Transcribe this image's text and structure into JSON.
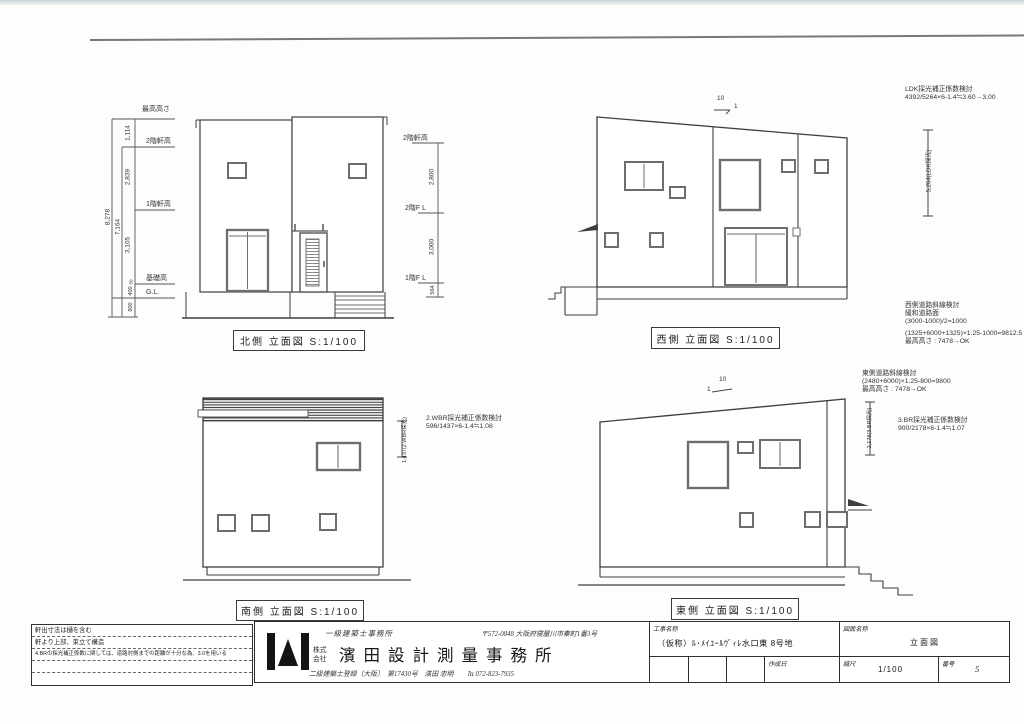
{
  "colors": {
    "ink": "#3a3a3a",
    "frame_line": "#787878",
    "window_gray": "#6e6e6e"
  },
  "views": {
    "north": {
      "label": "北側 立面図 S:1/100",
      "levels": {
        "max": "最高高さ",
        "eave2": "2階軒高",
        "eave1": "1階軒高",
        "foundation": "基礎高",
        "gl": "G.L."
      },
      "dims": {
        "d1114": "1,114",
        "d2839": "2,839",
        "d3105": "3,105",
        "d50": "50",
        "d400": "400",
        "d800": "800",
        "d7164": "7,164",
        "d8278": "8,278"
      }
    },
    "west": {
      "label": "西側 立面図 S:1/100",
      "slope_rise": "10",
      "slope_run": "1",
      "levels": {
        "eave2": "2階軒高",
        "fl2": "2階F L",
        "fl1": "1階F L"
      },
      "dims": {
        "d2800": "2,800",
        "d3000": "3,000",
        "d564": "564",
        "ldk": "5,264(LDK採光)"
      },
      "ldk_check": {
        "l1": "LDK採光補正係数検討",
        "l2": "4392/5264×6-1.4≒3.60→3.00"
      },
      "road_check": {
        "l1": "西側道路斜線検討",
        "l2": "緩和道路面",
        "l3": "(3000-1000)/2=1000",
        "l4": "(1325+6000+1325)×1.25-1000=9812.5",
        "l5": "最高高さ : 7478→OK"
      }
    },
    "south": {
      "label": "南側 立面図 S:1/100",
      "dims": {
        "wbr": "1,437(2.WBR採光)"
      },
      "wbr_check": {
        "l1": "2.WBR採光補正係数検討",
        "l2": "596/1437×6-1.4≒1.08"
      }
    },
    "east": {
      "label": "東側 立面図 S:1/100",
      "slope_rise": "10",
      "slope_run": "1",
      "road_check": {
        "l1": "東側道路斜線検討",
        "l2": "(2480+6000)×1.25-800=9800",
        "l3": "最高高さ : 7478→OK"
      },
      "dims": {
        "br": "2,178(3.BR採光)"
      },
      "br_check": {
        "l1": "3.BR採光補正係数検討",
        "l2": "900/2178×6-1.4≒1.07"
      }
    }
  },
  "titleblock": {
    "notes": {
      "n1": "軒出寸法は樋を含む",
      "n2": "軒より上部、束立て構造",
      "n3": "4.BRの採光補正係数に関しては、道路対側までの距離が十分な為、3.0を用いる"
    },
    "office_class": "一級建築士事務所",
    "address": "〒572-0848 大阪府寝屋川市秦町1番3号",
    "corp1": "株式",
    "corp2": "会社",
    "company": "濱田設計測量事務所",
    "registration": "二級建築士登録（大阪）　第17430号　濱田 忠明　　℡ 072-823-7935",
    "project_label": "工事名称",
    "project_value": "（仮称）ﾙ･ﾒｲﾕｰﾙｳﾞｨﾚ水口東 8号地",
    "drawing_label": "図面名称",
    "drawing_value": "立面図",
    "date_label": "作成日",
    "scale_label": "縮尺",
    "scale_value": "1/100",
    "number_label": "番号",
    "number_value": "5"
  }
}
